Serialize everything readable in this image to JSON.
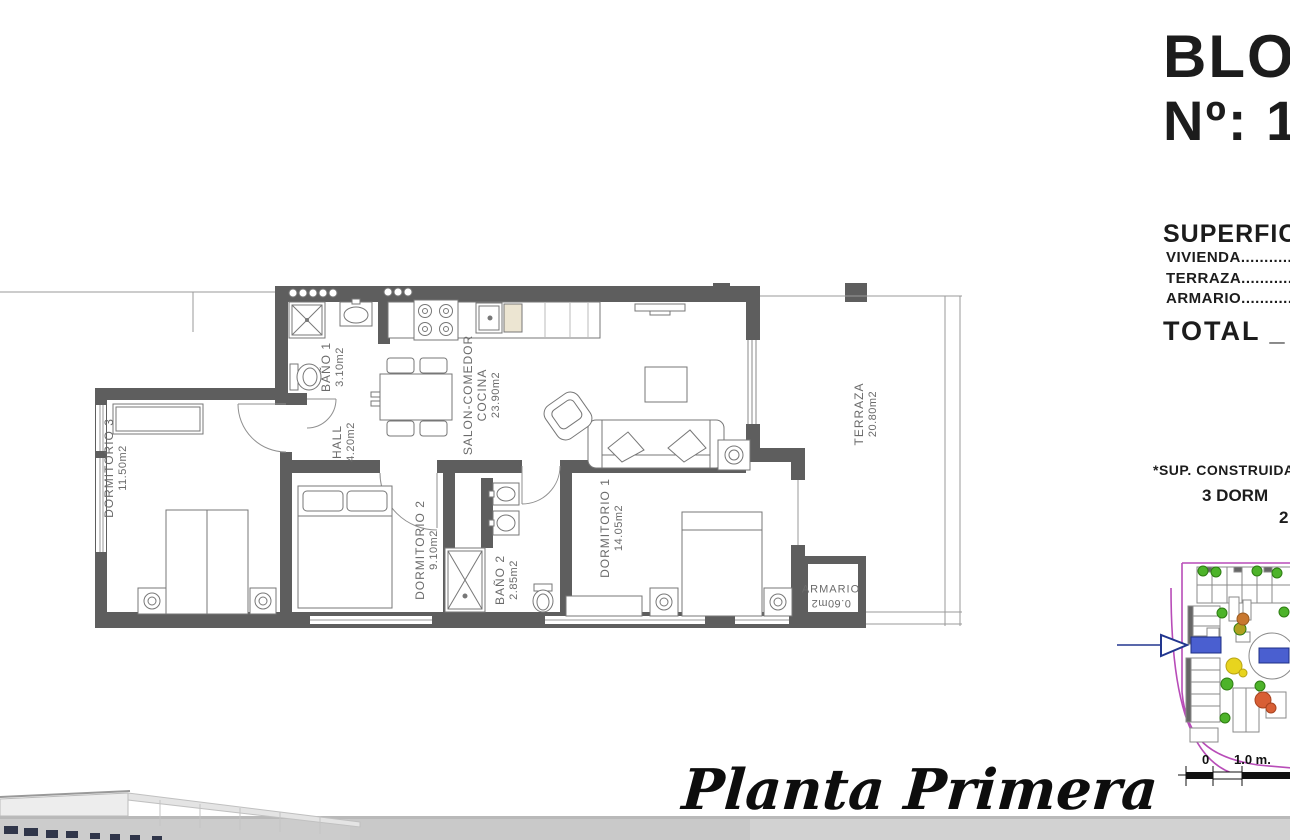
{
  "header": {
    "block": "BLOQ",
    "number": "Nº:  1"
  },
  "surfaces": {
    "title": "SUPERFICIE",
    "vivienda": "VIVIENDA.....................................",
    "terraza": "TERRAZA......................................",
    "armario": "ARMARIO.....................................",
    "total": "TOTAL  _  1"
  },
  "notes": {
    "sup_construidas": "*SUP. CONSTRUIDAS",
    "dorm": "3 DORM",
    "extra": "2"
  },
  "rooms": {
    "dormitorio3": {
      "name": "DORMITORIO 3",
      "area": "11.50m2"
    },
    "bano1": {
      "name": "BAÑO 1",
      "area": "3.10m2"
    },
    "hall": {
      "name": "HALL",
      "area": "4.20m2"
    },
    "salon": {
      "name": "SALON-COMEDOR",
      "name2": "COCINA",
      "area": "23.90m2"
    },
    "dormitorio2": {
      "name": "DORMITORIO 2",
      "area": "9.10m2"
    },
    "bano2": {
      "name": "BAÑO 2",
      "area": "2.85m2"
    },
    "dormitorio1": {
      "name": "DORMITORIO 1",
      "area": "14.05m2"
    },
    "terraza": {
      "name": "TERRAZA",
      "area": "20.80m2"
    },
    "armario": {
      "name": "ARMARIO",
      "area": "0.60m2"
    }
  },
  "footer": {
    "plan_title": "Planta Primera"
  },
  "scale_bar": {
    "zero": "0",
    "one_m": "1.0 m."
  },
  "colors": {
    "wall": "#5e5e5e",
    "furniture_line": "#777777",
    "label": "#6b6b6b",
    "site_magenta": "#b84cb8",
    "site_blue": "#4a5fd0",
    "tree_green": "#4db32a",
    "flower_yellow": "#e8d41e",
    "flower_orange": "#d85f35"
  }
}
